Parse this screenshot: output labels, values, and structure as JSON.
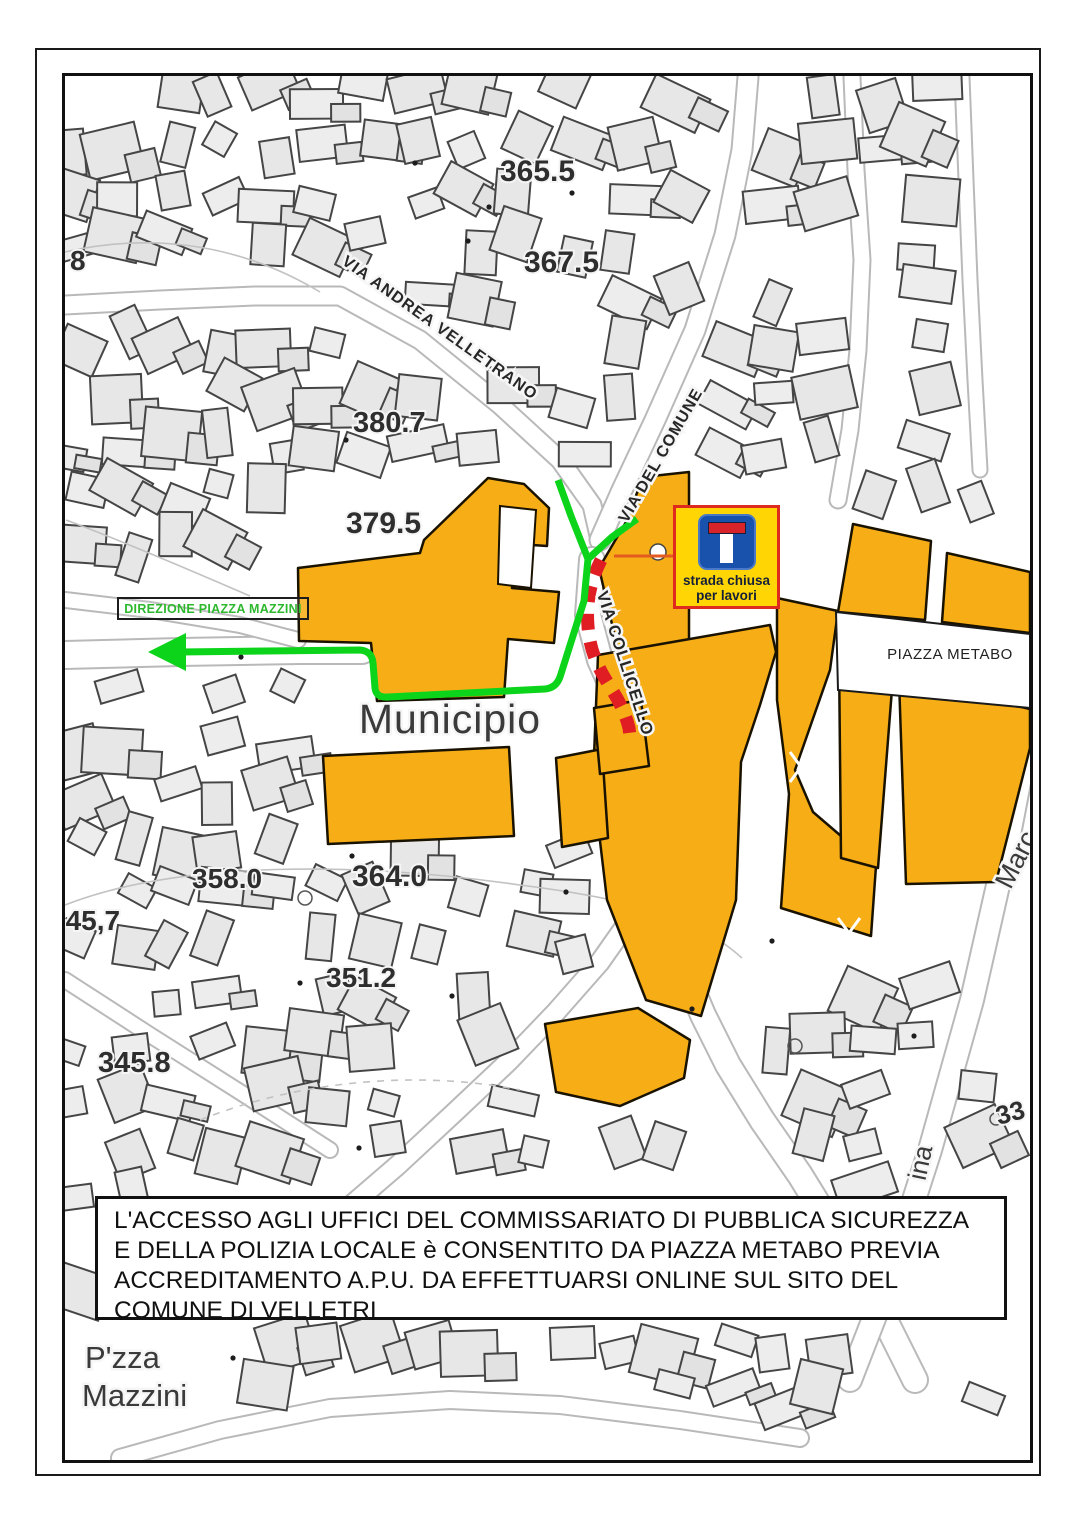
{
  "notice": {
    "text": "L'ACCESSO AGLI UFFICI DEL COMMISSARIATO DI PUBBLICA SICUREZZA E DELLA POLIZIA LOCALE è CONSENTITO DA PIAZZA METABO PREVIA ACCREDITAMENTO A.P.U. DA EFFETTUARSI ONLINE SUL SITO DEL COMUNE DI VELLETRI"
  },
  "road_sign": {
    "line1": "strada chiusa",
    "line2": "per lavori",
    "icon": "dead-end-icon"
  },
  "route": {
    "direction_label": "DIREZIONE PIAZZA MAZZINI"
  },
  "streets": {
    "andrea_velletrano": "VIA ANDREA VELLETRANO",
    "del_comune": "VIA DEL COMUNE",
    "collicello": "VIA COLLICELLO",
    "marc_partial": "Marc",
    "ina_partial": "ina"
  },
  "places": {
    "municipio": "Municipio",
    "piazza_metabo": "PIAZZA METABO",
    "pzza": "P'zza",
    "mazzini": "Mazzini"
  },
  "elevations": {
    "a": "365.5",
    "b": "367.5",
    "c": "380.7",
    "d": "379.5",
    "e": "358.0",
    "f": "364.0",
    "g": "345,7",
    "h": "351.2",
    "i": "345.8",
    "j": "8",
    "k": "33"
  },
  "colors": {
    "highlight_orange": "#F7AE16",
    "route_green": "#0BD41B",
    "closure_red": "#E01D23",
    "sign_yellow": "#FFD504",
    "sign_blue": "#1952AC",
    "sign_border_red": "#DE2B1E",
    "direction_green": "#2eb82e"
  }
}
